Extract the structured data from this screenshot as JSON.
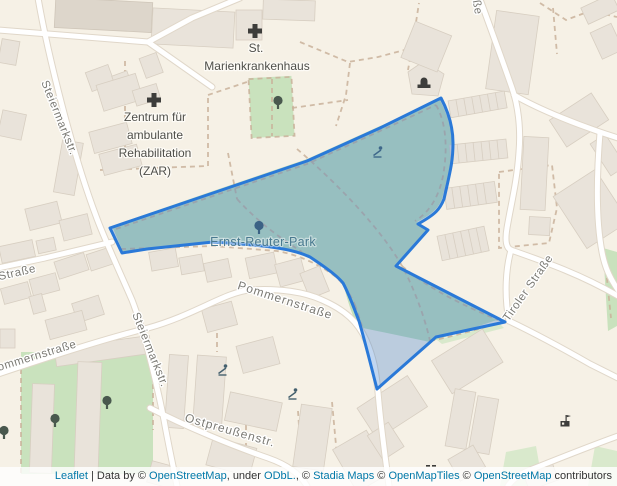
{
  "map": {
    "park": {
      "label": "Ernst-Reuter-Park"
    },
    "pois": {
      "marien_line1": "St.",
      "marien_line2": "Marienkrankenhaus",
      "zar_line1": "Zentrum für",
      "zar_line2": "ambulante",
      "zar_line3": "Rehabilitation",
      "zar_line4": "(ZAR)"
    },
    "streets": {
      "steiermarkstr_upper": "Steiermarkstr.",
      "steiermarkstr_lower": "Steiermarkstr.",
      "strasse_left": "Straße",
      "pommernstrasse_left": "ommernstraße",
      "pommernstrasse": "Pommernstraße",
      "ostpreussenstr": "Ostpreußenstr.",
      "tiroler_strasse": "Tiroler Straße",
      "top_edge_cut": "ße"
    },
    "icons": [
      "hospital-cross-icon",
      "tree-icon",
      "playground-icon",
      "theatre-icon",
      "building-flag-icon"
    ],
    "colors": {
      "background": "#f6f1e6",
      "building": "#e9e3da",
      "road": "#ffffff",
      "green": "#c9e2bd",
      "path_dash": "#c9b29a",
      "polygon_stroke": "#2a79d8",
      "polygon_fill": "rgba(51,120,205,0.30)",
      "park_label": "#49798f",
      "street_label": "#7b7a74",
      "link": "#0078A8"
    }
  },
  "attribution": {
    "leaflet": "Leaflet",
    "sep1": " | Data by © ",
    "osm1": "OpenStreetMap",
    "sep2": ", under ",
    "odbl": "ODbL.",
    "sep3": ", © ",
    "stadia": "Stadia Maps",
    "sep4": " © ",
    "openmaptiles": "OpenMapTiles",
    "sep5": " © ",
    "osm2": "OpenStreetMap",
    "sep6": " contributors"
  }
}
